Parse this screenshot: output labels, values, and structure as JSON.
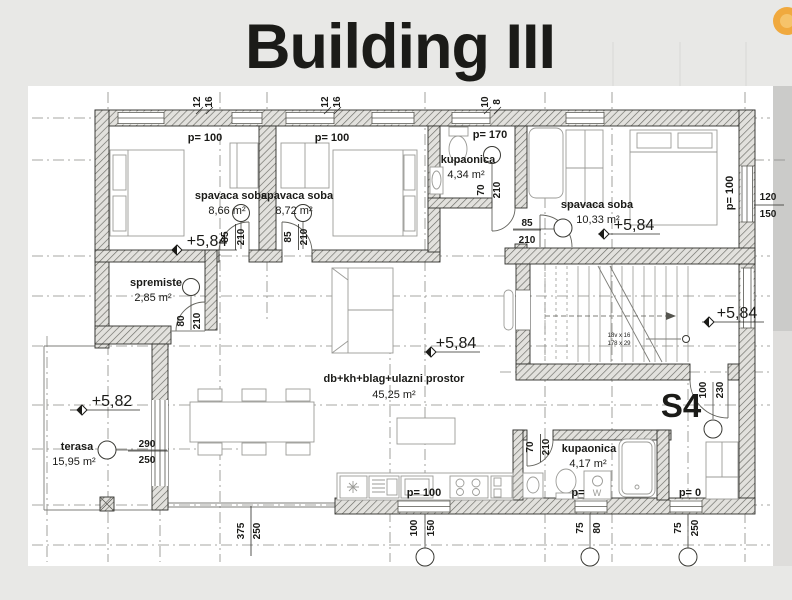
{
  "title": "Building III",
  "colors": {
    "background": "#e8e8e6",
    "paper": "#ffffff",
    "title_text": "#868e96",
    "accent_circle": "#f0a93e",
    "plan_line": "#2e2e2a",
    "dash_line": "#8a8a85"
  },
  "plan": {
    "rooms": {
      "bedroom1": {
        "name": "spavaca soba",
        "area": "8,66 m²"
      },
      "bedroom2": {
        "name": "spavaca soba",
        "area": "8,72 m²"
      },
      "bedroom3": {
        "name": "spavaca soba",
        "area": "10,33 m²"
      },
      "bathroom_top": {
        "name": "kupaonica",
        "area": "4,34 m²"
      },
      "bathroom_bottom": {
        "name": "kupaonica",
        "area": "4,17 m²"
      },
      "storage": {
        "name": "spremiste",
        "area": "2,85 m²"
      },
      "living": {
        "name": "db+kh+blag+ulazni prostor",
        "area": "45,25 m²"
      },
      "terrace": {
        "name": "terasa",
        "area": "15,95 m²"
      }
    },
    "levels": {
      "main": "+5,84",
      "terrace": "+5,82"
    },
    "parapets": {
      "p100": "p=  100",
      "p170": "p=  170",
      "p0": "p=  0",
      "p_only": "p="
    },
    "stairs": {
      "unit": "S4",
      "note1": "18v x 16",
      "note2": "178 x 29"
    },
    "appliances": {
      "washer": "W"
    },
    "dims": {
      "d85": "85",
      "d210": "210",
      "d70": "70",
      "d80": "80",
      "d100": "100",
      "d230": "230",
      "d290": "290",
      "d250": "250",
      "d375": "375",
      "d150": "150",
      "d120": "120",
      "d75": "75",
      "d12": "12",
      "d16": "16",
      "d10": "10",
      "d8": "8"
    }
  }
}
